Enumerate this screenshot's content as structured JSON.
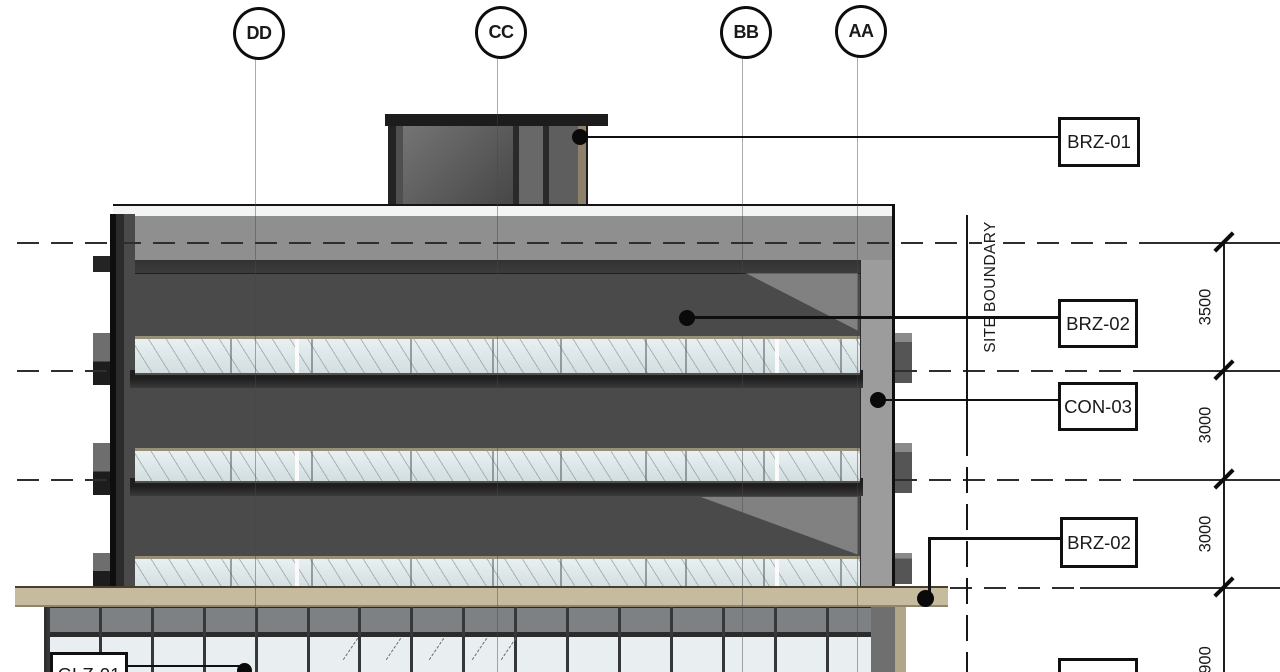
{
  "drawing": {
    "grid": {
      "bubbles": [
        {
          "label": "DD"
        },
        {
          "label": "CC"
        },
        {
          "label": "BB"
        },
        {
          "label": "AA"
        }
      ]
    },
    "site_boundary": {
      "label": "SITE BOUNDARY"
    },
    "dimensions": {
      "values": [
        {
          "text": "3500"
        },
        {
          "text": "3000"
        },
        {
          "text": "3000"
        },
        {
          "text": "900"
        }
      ]
    },
    "callouts": {
      "brz01": {
        "label": "BRZ-01"
      },
      "brz02_upper": {
        "label": "BRZ-02"
      },
      "con03": {
        "label": "CON-03"
      },
      "brz02_lower": {
        "label": "BRZ-02"
      },
      "glz01": {
        "label": "GLZ-01"
      },
      "bottom_partial": {
        "label": ""
      }
    },
    "facade_symbols": {
      "slide_right": "→",
      "slide_left": "←"
    }
  }
}
